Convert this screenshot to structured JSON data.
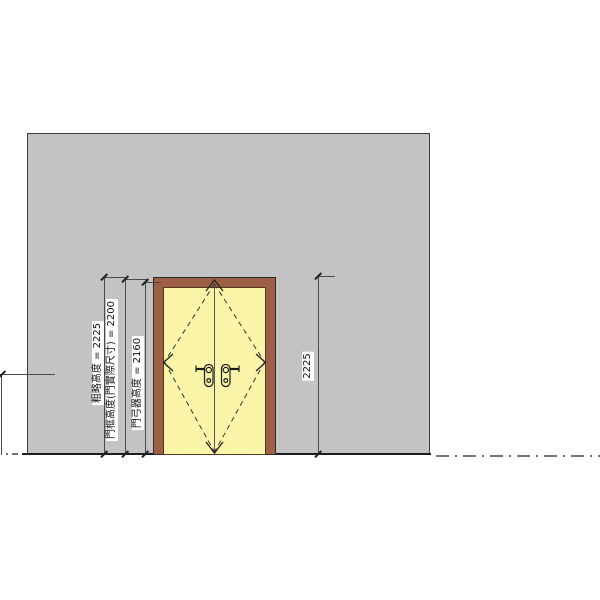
{
  "drawing": {
    "dimensions": {
      "left": [
        {
          "name": "rough-height",
          "label": "粗略高度 = 2225",
          "value": 2225
        },
        {
          "name": "frame-height",
          "label": "門框高度(門實際尺寸) = 2200",
          "value": 2200
        },
        {
          "name": "door-closer-height",
          "label": "門弓器高度 = 2160",
          "value": 2160
        }
      ],
      "right": {
        "name": "head-height",
        "label": "2225",
        "value": 2225
      }
    },
    "colors": {
      "wall": "#c3c3c3",
      "door_frame": "#9d5f45",
      "door_panel": "#fbf5a9",
      "outline": "#2b2b2b",
      "dimension_line": "#4a4a4a",
      "centerline": "#767676",
      "background": "#ffffff"
    }
  }
}
